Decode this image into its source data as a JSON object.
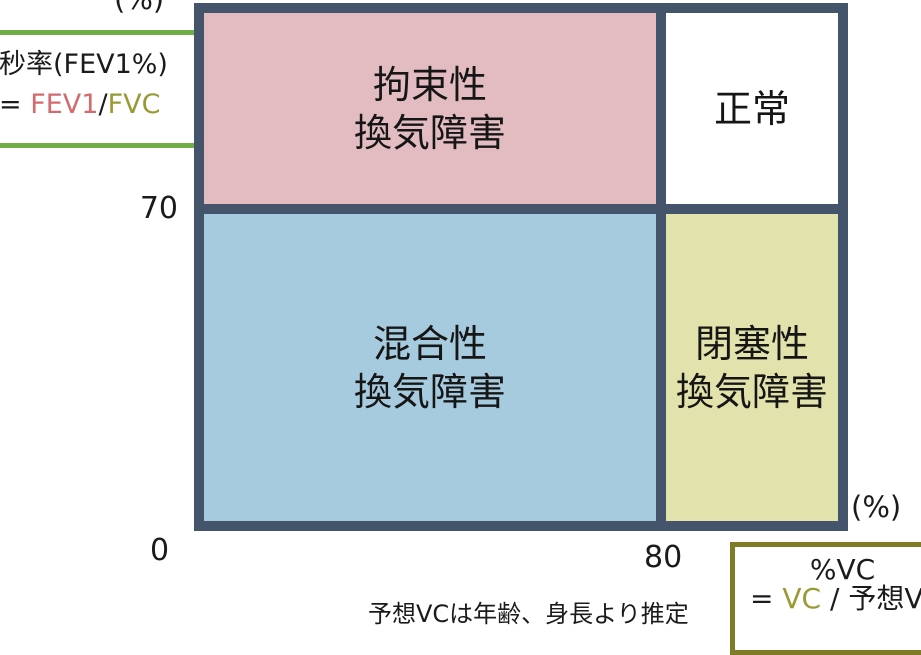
{
  "diagram": {
    "title_hint": "spirometry-ventilatory-impairment-quadrant-diagram",
    "quadrants": {
      "restrictive": {
        "label": "拘束性\n換気障害",
        "fill": "#E2BCC0",
        "position": "top-left"
      },
      "normal": {
        "label": "正常",
        "fill": "#FFFFFF",
        "position": "top-right"
      },
      "mixed": {
        "label": "混合性\n換気障害",
        "fill": "#A7CBDE",
        "position": "bottom-left"
      },
      "obstructive": {
        "label": "閉塞性\n換気障害",
        "fill": "#E2E2AC",
        "position": "bottom-right"
      }
    },
    "y_axis": {
      "unit": "(%)",
      "tick_70": "70"
    },
    "x_axis": {
      "unit": "(%)",
      "tick_0": "0",
      "tick_80": "80"
    }
  },
  "fev1_box": {
    "title": "秒率(FEV1%)",
    "eq": "= ",
    "numerator": "FEV1",
    "slash": "/",
    "denominator": "FVC"
  },
  "vc_box": {
    "title": "%VC",
    "eq": "= ",
    "numerator": "VC",
    "rest": " / 予想VC"
  },
  "footnote": "予想VCは年齢、身長より推定",
  "colors": {
    "chart_border": "#44546A",
    "quadrant_pink": "#E2BCC0",
    "quadrant_blue": "#A7CBDE",
    "quadrant_olive": "#E2E2AC",
    "fev1_box_border": "#70AD47",
    "vc_box_border": "#7E7D25",
    "fev1_text": "#D26B6E",
    "fvc_text": "#9A9A35"
  }
}
